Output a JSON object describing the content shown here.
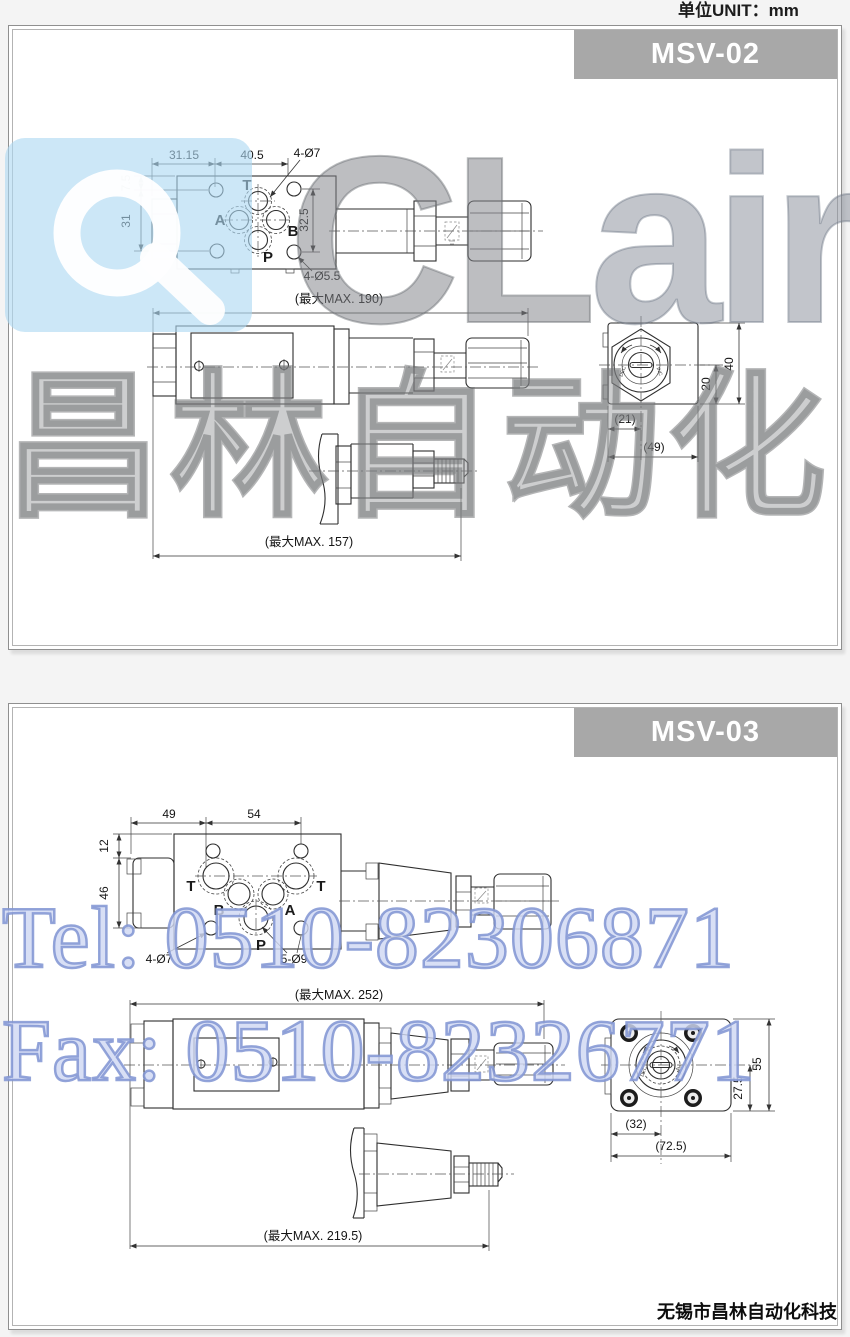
{
  "page": {
    "unit_label": "单位UNIT：mm",
    "footer": "无锡市昌林自动化科技"
  },
  "watermarks": {
    "logo_a": "a",
    "logo_cl": "CL",
    "logo_air": "air",
    "logo_cn": "昌林自动化",
    "tel": "Tel: 0510-82306871",
    "fax": "Fax: 0510-82326771"
  },
  "colors": {
    "model_bar_gray": "#a8a8a8",
    "panel_border": "#b3b3b3",
    "watermark_blue_box": "#add8f2",
    "watermark_gray": "#84878b",
    "watermark_tel_blue": "#8094d2",
    "line_color": "#2e2e2e"
  },
  "p1": {
    "model": "MSV-02",
    "tv": {
      "d3115": "31.15",
      "d405": "40.5",
      "d4d7": "4-Ø7",
      "d75": "7.5",
      "d31": "31",
      "d325": "32.5",
      "d4d55": "4-Ø5.5",
      "pt": "T",
      "pa": "A",
      "pb": "B",
      "pp": "P"
    },
    "sv": {
      "max190": "(最大MAX. 190)"
    },
    "pv": {
      "max157": "(最大MAX. 157)"
    },
    "ev": {
      "d21": "(21)",
      "d49": "(49)",
      "d20": "20",
      "d40": "40",
      "dec": "DEC",
      "inc": "INC"
    }
  },
  "p2": {
    "model": "MSV-03",
    "tv": {
      "d49": "49",
      "d54": "54",
      "d12": "12",
      "d46": "46",
      "d4d7": "4-Ø7",
      "d5d9": "5-Ø9",
      "pt1": "T",
      "pt2": "T",
      "pa": "A",
      "pb": "B",
      "pp": "P"
    },
    "sv": {
      "max252": "(最大MAX. 252)"
    },
    "pv": {
      "max2195": "(最大MAX. 219.5)"
    },
    "ev": {
      "d32": "(32)",
      "d725": "(72.5)",
      "d275": "27.5",
      "d55": "55",
      "dec": "DEC",
      "inc": "INC"
    }
  }
}
